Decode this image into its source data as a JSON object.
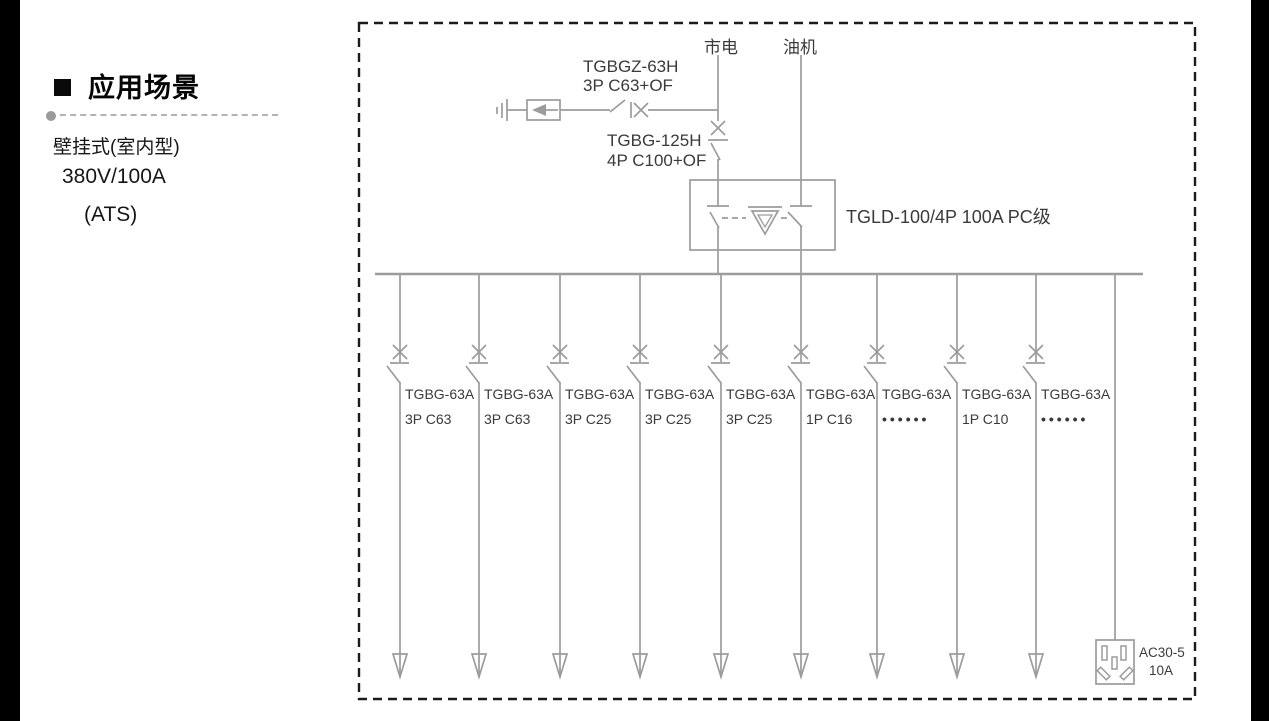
{
  "panel": {
    "heading": "应用场景",
    "line1": "壁挂式(室内型)",
    "line2": "380V/100A",
    "line3": "(ATS)"
  },
  "diagram": {
    "source_mains": "市电",
    "source_generator": "油机",
    "surge_breaker": {
      "model": "TGBGZ-63H",
      "spec": "3P C63+OF"
    },
    "main_breaker": {
      "model": "TGBG-125H",
      "spec": "4P C100+OF"
    },
    "ats_label": "TGLD-100/4P 100A PC级",
    "branches": [
      {
        "model": "TGBG-63A",
        "spec": "3P C63"
      },
      {
        "model": "TGBG-63A",
        "spec": "3P C63"
      },
      {
        "model": "TGBG-63A",
        "spec": "3P C25"
      },
      {
        "model": "TGBG-63A",
        "spec": "3P C25"
      },
      {
        "model": "TGBG-63A",
        "spec": "3P C25"
      },
      {
        "model": "TGBG-63A",
        "spec": "1P C16"
      },
      {
        "model": "TGBG-63A",
        "spec": "••••••"
      },
      {
        "model": "TGBG-63A",
        "spec": "1P C10"
      },
      {
        "model": "TGBG-63A",
        "spec": "••••••"
      }
    ],
    "socket": {
      "model": "AC30-5",
      "rating": "10A"
    }
  },
  "colors": {
    "diagram_line": "#9c9c9c",
    "diagram_text": "#3a3a3a",
    "dashed_border": "#1b1b1b",
    "side_bars": "#000000"
  }
}
